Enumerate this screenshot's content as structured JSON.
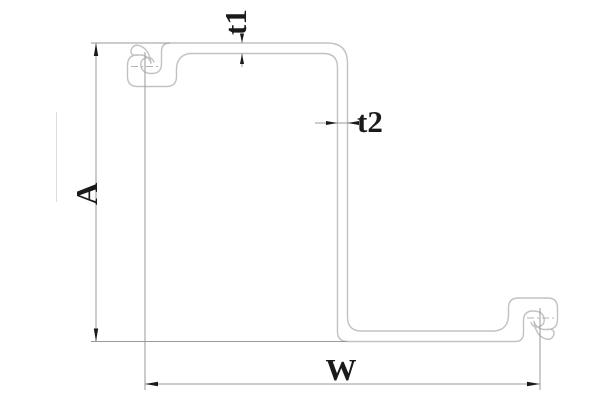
{
  "drawing": {
    "title": "Z-shaped sheet pile cross-section with interlocks",
    "labels": {
      "height": "A",
      "width": "W",
      "flange_thickness": "t1",
      "web_thickness": "t2"
    },
    "colors": {
      "background": "#ffffff",
      "profile_outline": "#c2c2c2",
      "dimension_lines": "#9a9a9a",
      "text_and_arrows": "#1a1a1a"
    }
  }
}
